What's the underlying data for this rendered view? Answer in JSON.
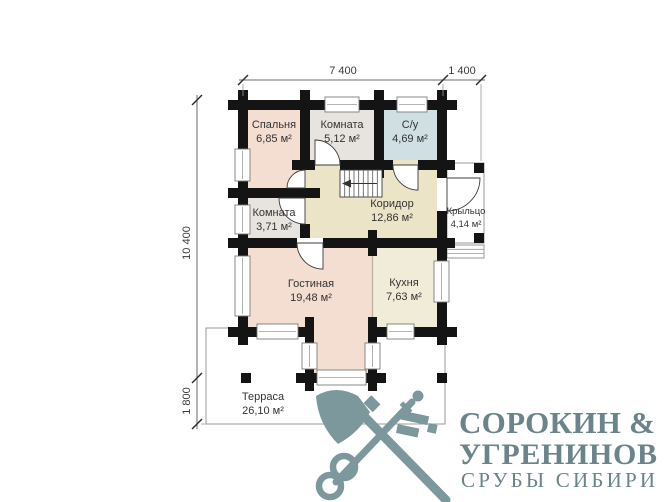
{
  "plan": {
    "wall_color": "#141414",
    "rooms": [
      {
        "name": "Спальня",
        "area": "6,85 м²",
        "color": "#f4ddd1"
      },
      {
        "name": "Комната",
        "area": "5,12 м²",
        "color": "#e7e4df"
      },
      {
        "name": "С/у",
        "area": "4,69 м²",
        "color": "#cfdfe4"
      },
      {
        "name": "Комната",
        "area": "3,71 м²",
        "color": "#e7e4df"
      },
      {
        "name": "Коридор",
        "area": "12,86 м²",
        "color": "#ece4c6"
      },
      {
        "name": "Крыльцо",
        "area": "4,14 м²",
        "color": "#ffffff"
      },
      {
        "name": "Гостиная",
        "area": "19,48 м²",
        "color": "#f4ddd1"
      },
      {
        "name": "Кухня",
        "area": "7,63 м²",
        "color": "#f1ecd7"
      },
      {
        "name": "Терраса",
        "area": "26,10 м²",
        "color": "#ffffff"
      }
    ],
    "dimensions": {
      "top_main": "7 400",
      "top_porch": "1 400",
      "side_main": "10 400",
      "side_terrace": "1 800"
    }
  },
  "logo": {
    "line1": "СОРОКИН &",
    "line2": "УГРЕНИНОВ",
    "line3": "СРУБЫ СИБИРИ",
    "color": "#6a8489",
    "icon_color": "#7d989c",
    "icon": "crossed-axe-and-key"
  }
}
